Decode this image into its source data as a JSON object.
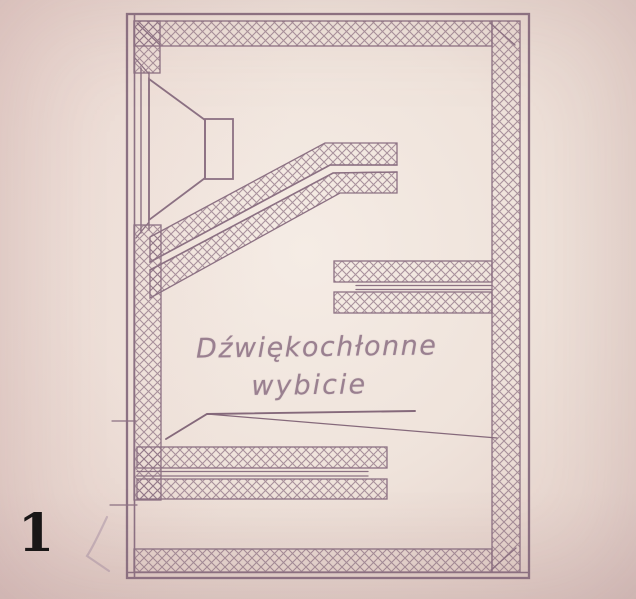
{
  "figure": {
    "number": "1"
  },
  "annotation": {
    "line1": "Dźwiękochłonne",
    "line2": "wybicie"
  },
  "colors": {
    "paper_center": "#f5ece5",
    "paper_edge": "#ddc8c4",
    "ink": "#8c7183",
    "annotation_ink": "#9a8090",
    "figure_number_ink": "#121212",
    "pencil_mark": "#927c98"
  }
}
